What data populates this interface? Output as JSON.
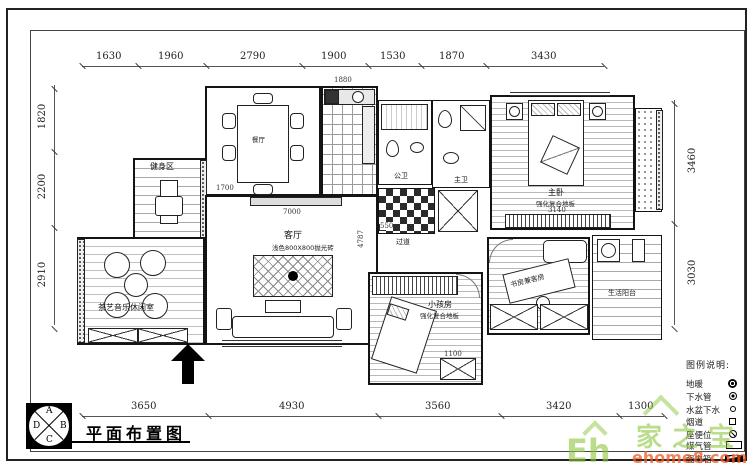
{
  "title_block": {
    "title": "平面布置图",
    "compass": {
      "top": "A",
      "right": "B",
      "bottom": "C",
      "left": "D"
    }
  },
  "dims": {
    "top": [
      "1630",
      "1960",
      "2790",
      "1900",
      "1530",
      "1870",
      "3430"
    ],
    "bottom": [
      "3650",
      "4930",
      "3560",
      "3420",
      "1300"
    ],
    "left": [
      "1820",
      "2200",
      "2910"
    ],
    "right": [
      "3460",
      "3030"
    ],
    "inner": {
      "dining": "1700",
      "kitchen": "1880",
      "living_w": "7000",
      "living_h": "4787",
      "master": "3140",
      "kids": "1100",
      "hall": "550"
    }
  },
  "rooms": {
    "fitness": "健身区",
    "dining": "餐厅",
    "living": "客厅",
    "living_sub": "浅色800X800抛光砖",
    "tea": "茶艺音乐休闲室",
    "bath_public": "公卫",
    "bath_master": "主卫",
    "hall": "过道",
    "master": "主卧",
    "master_sub": "强化复合地板",
    "study": "书房兼客房",
    "kids": "小孩房",
    "kids_sub": "强化复合地板",
    "service_balcony": "生活阳台"
  },
  "legend": {
    "header": "图例说明:",
    "items": [
      {
        "label": "地暖",
        "icon": "floor-heating-icon"
      },
      {
        "label": "下水管",
        "icon": "drain-pipe-icon"
      },
      {
        "label": "水盆下水",
        "icon": "basin-drain-icon"
      },
      {
        "label": "烟道",
        "icon": "flue-icon"
      },
      {
        "label": "座便位",
        "icon": "toilet-position-icon"
      },
      {
        "label": "煤气管",
        "icon": "gas-pipe-icon"
      },
      {
        "label": "强电箱",
        "icon": "power-box-icon"
      }
    ]
  },
  "watermark": {
    "eh": "Eh",
    "brand": "家之宝",
    "site": "ehome8.com"
  },
  "colors": {
    "line": "#141414",
    "floor_line": "#b9b9b9",
    "watermark_green": "#8dc63f",
    "watermark_orange": "#f15a24"
  }
}
